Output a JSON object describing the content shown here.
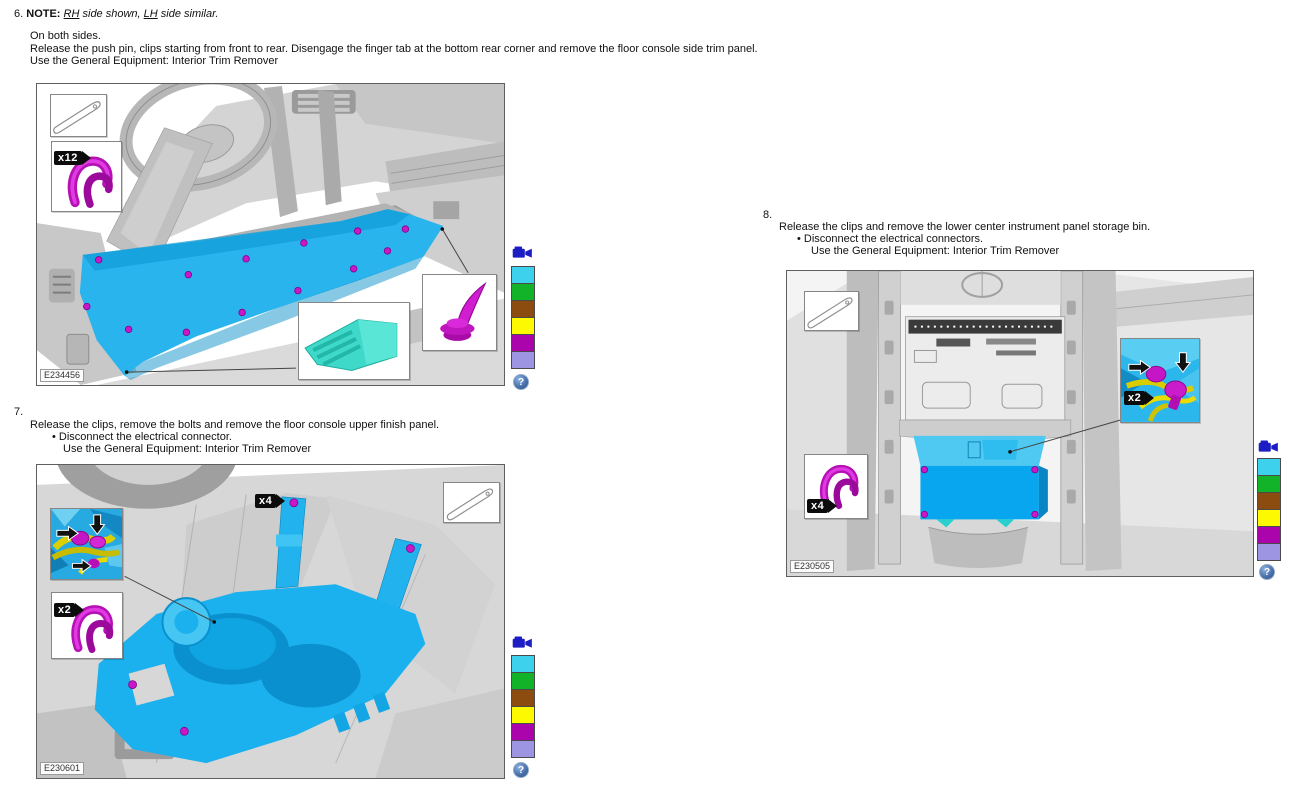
{
  "ui": {
    "bullet_glyph": "•"
  },
  "steps": {
    "step6": {
      "number": "6.",
      "note_label": "NOTE:",
      "note_rh": "RH",
      "note_mid": " side shown, ",
      "note_lh": "LH",
      "note_tail": " side similar.",
      "line1": "On both sides.",
      "line2": "Release the push pin, clips starting from front to rear. Disengage the finger tab at the bottom rear corner and remove the floor console side trim panel.",
      "line3": "Use the General Equipment: Interior Trim Remover"
    },
    "step7": {
      "number": "7.",
      "line1": "Release the clips, remove the bolts and remove the floor console upper finish panel.",
      "bullet": "Disconnect the electrical connector.",
      "equipment": "Use the General Equipment: Interior Trim Remover"
    },
    "step8": {
      "number": "8.",
      "line1": "Release the clips and remove the lower center instrument panel storage bin.",
      "bullet": "Disconnect the electrical connectors.",
      "equipment": "Use the General Equipment: Interior Trim Remover"
    }
  },
  "figures": {
    "fig1": {
      "id": "E234456",
      "clip_callout": "x12"
    },
    "fig2": {
      "id": "E230601",
      "bolt_callout": "x4",
      "clip_callout": "x2"
    },
    "fig3": {
      "id": "E230505",
      "connector_callout": "x2",
      "clip_callout": "x4"
    }
  },
  "legend": {
    "swatches": [
      "#3ed1ee",
      "#12b229",
      "#8c4b0f",
      "#fdf900",
      "#ac04ac",
      "#9d94e2"
    ],
    "help_glyph": "?"
  },
  "highlight_colors": {
    "panel_blue": "#1db1ee",
    "clip_magenta": "#c616c6",
    "tab_cyan": "#3fd9c8",
    "harness_yellow": "#e0d400",
    "camera_blue": "#1d1dc4"
  }
}
